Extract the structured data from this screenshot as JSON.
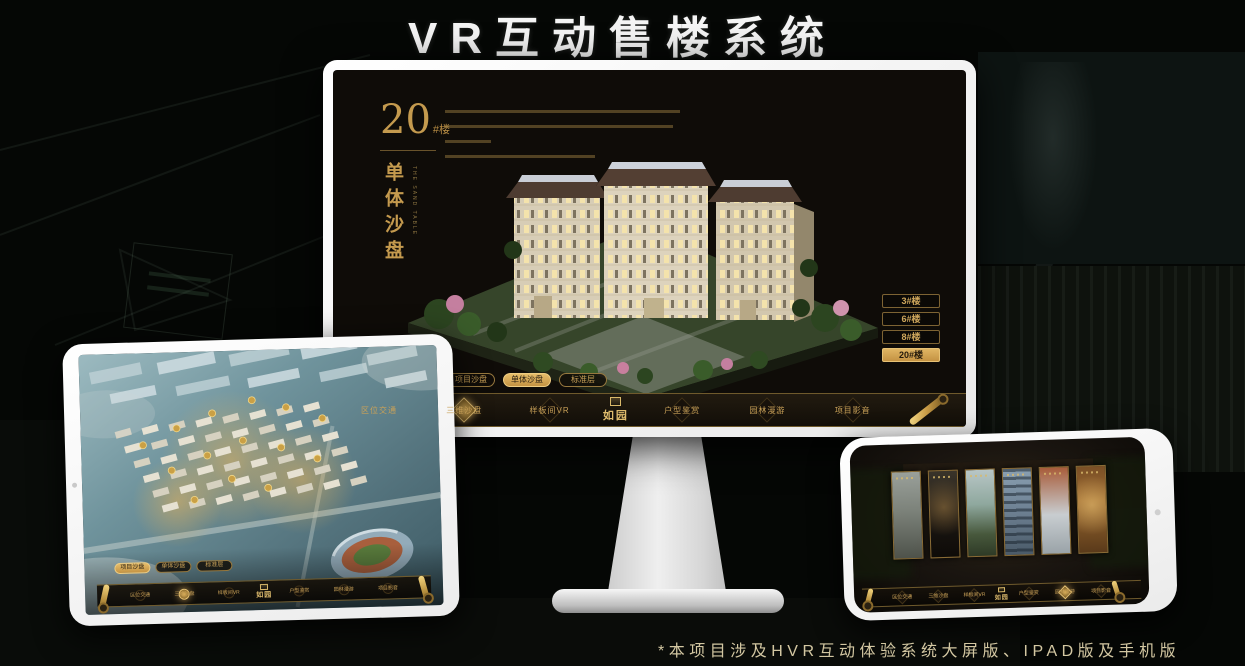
{
  "header": {
    "title": "VR互动售楼系统"
  },
  "footnote": {
    "text": "*本项目涉及HVR互动体验系统大屏版、IPAD版及手机版"
  },
  "colors": {
    "gold": "#c9a158",
    "gold_active_bg": "#d9ad5c",
    "screen_bg": "#0f0c08",
    "title_white": "#f5f5f5"
  },
  "monitor_app": {
    "building_number": "20",
    "building_suffix": "#楼",
    "view_title": "单体沙盘",
    "view_title_en": "THE SAND TABLE",
    "floor_buttons": [
      {
        "label": "3#楼",
        "active": false
      },
      {
        "label": "6#楼",
        "active": false
      },
      {
        "label": "8#楼",
        "active": false
      },
      {
        "label": "20#楼",
        "active": true
      }
    ],
    "mode_tabs": [
      {
        "label": "项目沙盘",
        "active": false
      },
      {
        "label": "单体沙盘",
        "active": true
      },
      {
        "label": "标准层",
        "active": false
      }
    ],
    "nav": {
      "logo": "如园",
      "items": [
        {
          "label": "区位交通",
          "active": false
        },
        {
          "label": "三维沙盘",
          "active": true
        },
        {
          "label": "样板间VR",
          "active": false
        },
        {
          "label": "户型鉴赏",
          "active": false
        },
        {
          "label": "园林漫游",
          "active": false
        },
        {
          "label": "项目影音",
          "active": false
        }
      ]
    }
  },
  "tablet_app": {
    "mode_tabs": [
      {
        "label": "项目沙盘",
        "active": true
      },
      {
        "label": "单体沙盘",
        "active": false
      },
      {
        "label": "标准层",
        "active": false
      }
    ],
    "nav": {
      "logo": "如园",
      "items": [
        {
          "label": "区位交通",
          "active": false
        },
        {
          "label": "三维沙盘",
          "active": true
        },
        {
          "label": "样板间VR",
          "active": false
        },
        {
          "label": "户型鉴赏",
          "active": false
        },
        {
          "label": "园林漫游",
          "active": false
        },
        {
          "label": "项目影音",
          "active": false
        }
      ]
    }
  },
  "phone_app": {
    "nav": {
      "logo": "如园",
      "items": [
        {
          "label": "区位交通",
          "active": false
        },
        {
          "label": "三维沙盘",
          "active": false
        },
        {
          "label": "样板间VR",
          "active": false
        },
        {
          "label": "户型鉴赏",
          "active": false
        },
        {
          "label": "园林漫游",
          "active": true
        },
        {
          "label": "项目影音",
          "active": false
        }
      ]
    }
  }
}
